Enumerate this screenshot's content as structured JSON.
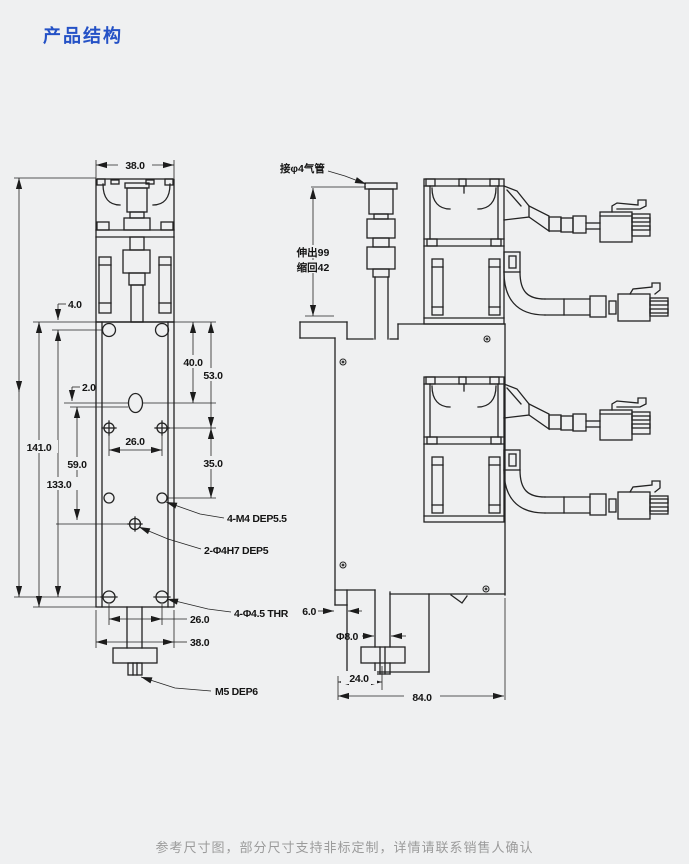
{
  "page": {
    "title": "产品结构",
    "footer": "参考尺寸图，部分尺寸支持非标定制，详情请联系销售人确认"
  },
  "theme": {
    "background": "#eff0f1",
    "title_color": "#2451c6",
    "line_color": "#232323",
    "footer_color": "#9b9b9b"
  },
  "front_view": {
    "dim_width_top": "38.0",
    "dim_edge_offset": "4.0",
    "dim_center_offset": "2.0",
    "dim_hole_pitch": "26.0",
    "dim_oval_from_top": "40.0",
    "dim_upper_span": "53.0",
    "dim_lower_span": "35.0",
    "dim_dowel_span": "59.0",
    "dim_slot_span": "133.0",
    "dim_total_height": "141.0",
    "dim_hole_pitch_bottom": "26.0",
    "dim_width_bottom": "38.0",
    "callout_m4": "4-M4 DEP5.5",
    "callout_dowel": "2-Φ4H7 DEP5",
    "callout_thr": "4-Φ4.5 THR",
    "callout_m5": "M5 DEP6"
  },
  "side_view": {
    "label_air_tube": "接φ4气管",
    "label_extend": "伸出99",
    "label_retract": "缩回42",
    "dim_notch": "6.0",
    "dim_shaft_dia": "Φ8.0",
    "dim_shaft_offset": "24.0",
    "dim_body_width": "84.0"
  }
}
